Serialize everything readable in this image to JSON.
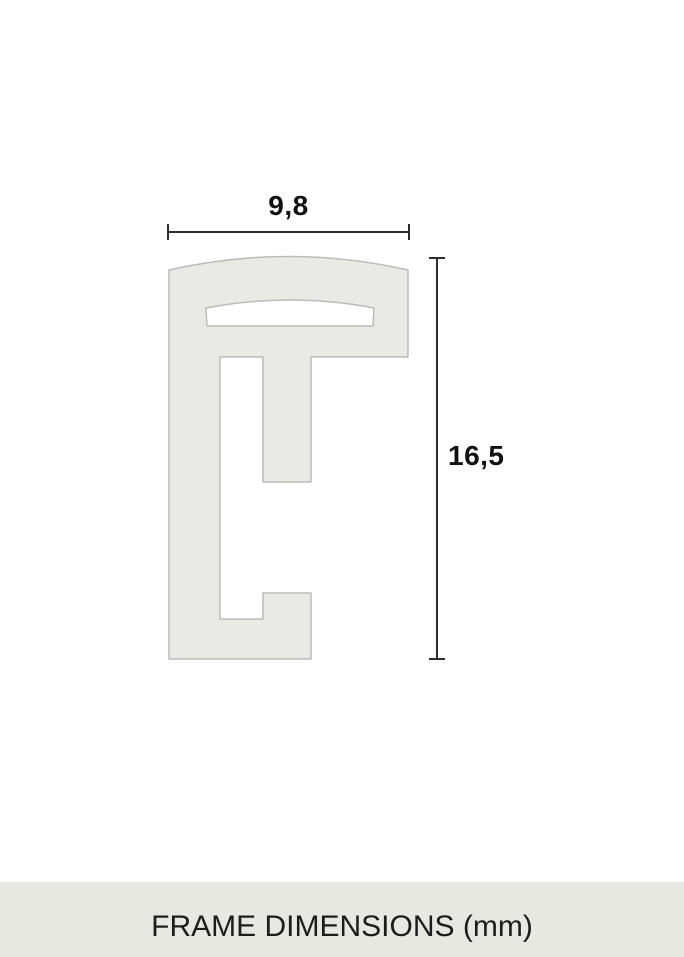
{
  "diagram": {
    "type": "frame-profile-cross-section",
    "width_label": "9,8",
    "height_label": "16,5",
    "width_mm": 9.8,
    "height_mm": 16.5,
    "unit": "mm",
    "colors": {
      "profile_fill": "#e9e9e5",
      "profile_stroke": "#bcbcb8",
      "dimension_line": "#2c2c2c",
      "label_text": "#111111"
    }
  },
  "caption": {
    "text": "FRAME DIMENSIONS (mm)",
    "bar_color": "#e8e8e3",
    "text_color": "#1d1d1d"
  }
}
